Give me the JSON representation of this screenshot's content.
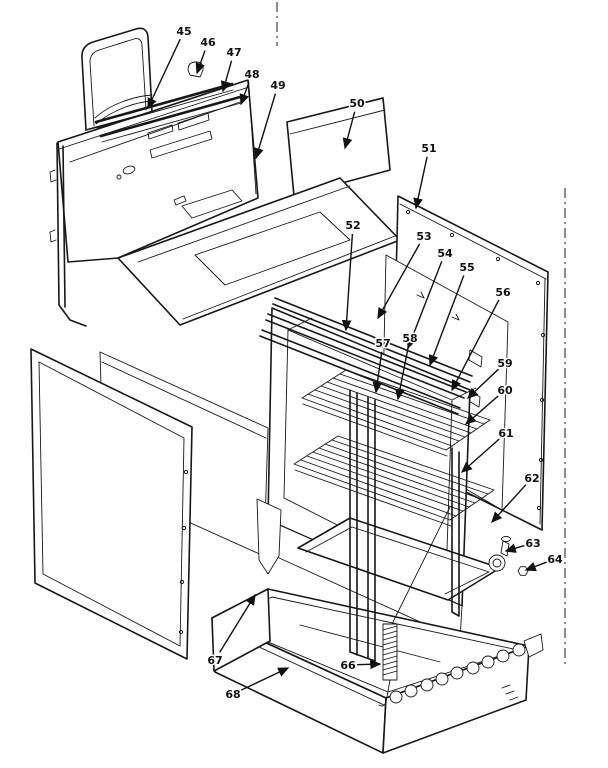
{
  "diagram": {
    "kind": "exploded-parts-diagram",
    "background": "#ffffff",
    "ink": "#171717",
    "part_labels": [
      {
        "num": "45",
        "x": 184,
        "y": 31,
        "tx": 148,
        "ty": 108
      },
      {
        "num": "46",
        "x": 208,
        "y": 42,
        "tx": 197,
        "ty": 73
      },
      {
        "num": "47",
        "x": 234,
        "y": 52,
        "tx": 223,
        "ty": 91
      },
      {
        "num": "48",
        "x": 252,
        "y": 74,
        "tx": 241,
        "ty": 104
      },
      {
        "num": "49",
        "x": 278,
        "y": 85,
        "tx": 256,
        "ty": 158
      },
      {
        "num": "50",
        "x": 357,
        "y": 103,
        "tx": 345,
        "ty": 148
      },
      {
        "num": "51",
        "x": 429,
        "y": 148,
        "tx": 416,
        "ty": 208
      },
      {
        "num": "52",
        "x": 353,
        "y": 225,
        "tx": 346,
        "ty": 330
      },
      {
        "num": "53",
        "x": 424,
        "y": 236,
        "tx": 378,
        "ty": 318
      },
      {
        "num": "54",
        "x": 445,
        "y": 253,
        "tx": 408,
        "ty": 348
      },
      {
        "num": "55",
        "x": 467,
        "y": 267,
        "tx": 430,
        "ty": 365
      },
      {
        "num": "56",
        "x": 503,
        "y": 292,
        "tx": 452,
        "ty": 390
      },
      {
        "num": "57",
        "x": 383,
        "y": 343,
        "tx": 376,
        "ty": 392
      },
      {
        "num": "58",
        "x": 410,
        "y": 338,
        "tx": 398,
        "ty": 399
      },
      {
        "num": "59",
        "x": 505,
        "y": 363,
        "tx": 468,
        "ty": 398
      },
      {
        "num": "60",
        "x": 505,
        "y": 390,
        "tx": 466,
        "ty": 424
      },
      {
        "num": "61",
        "x": 506,
        "y": 433,
        "tx": 462,
        "ty": 472
      },
      {
        "num": "62",
        "x": 532,
        "y": 478,
        "tx": 492,
        "ty": 522
      },
      {
        "num": "63",
        "x": 533,
        "y": 543,
        "tx": 506,
        "ty": 551
      },
      {
        "num": "64",
        "x": 555,
        "y": 559,
        "tx": 526,
        "ty": 570
      },
      {
        "num": "66",
        "x": 348,
        "y": 665,
        "tx": 380,
        "ty": 664
      },
      {
        "num": "67",
        "x": 215,
        "y": 660,
        "tx": 255,
        "ty": 595
      },
      {
        "num": "68",
        "x": 233,
        "y": 694,
        "tx": 288,
        "ty": 668
      }
    ]
  }
}
